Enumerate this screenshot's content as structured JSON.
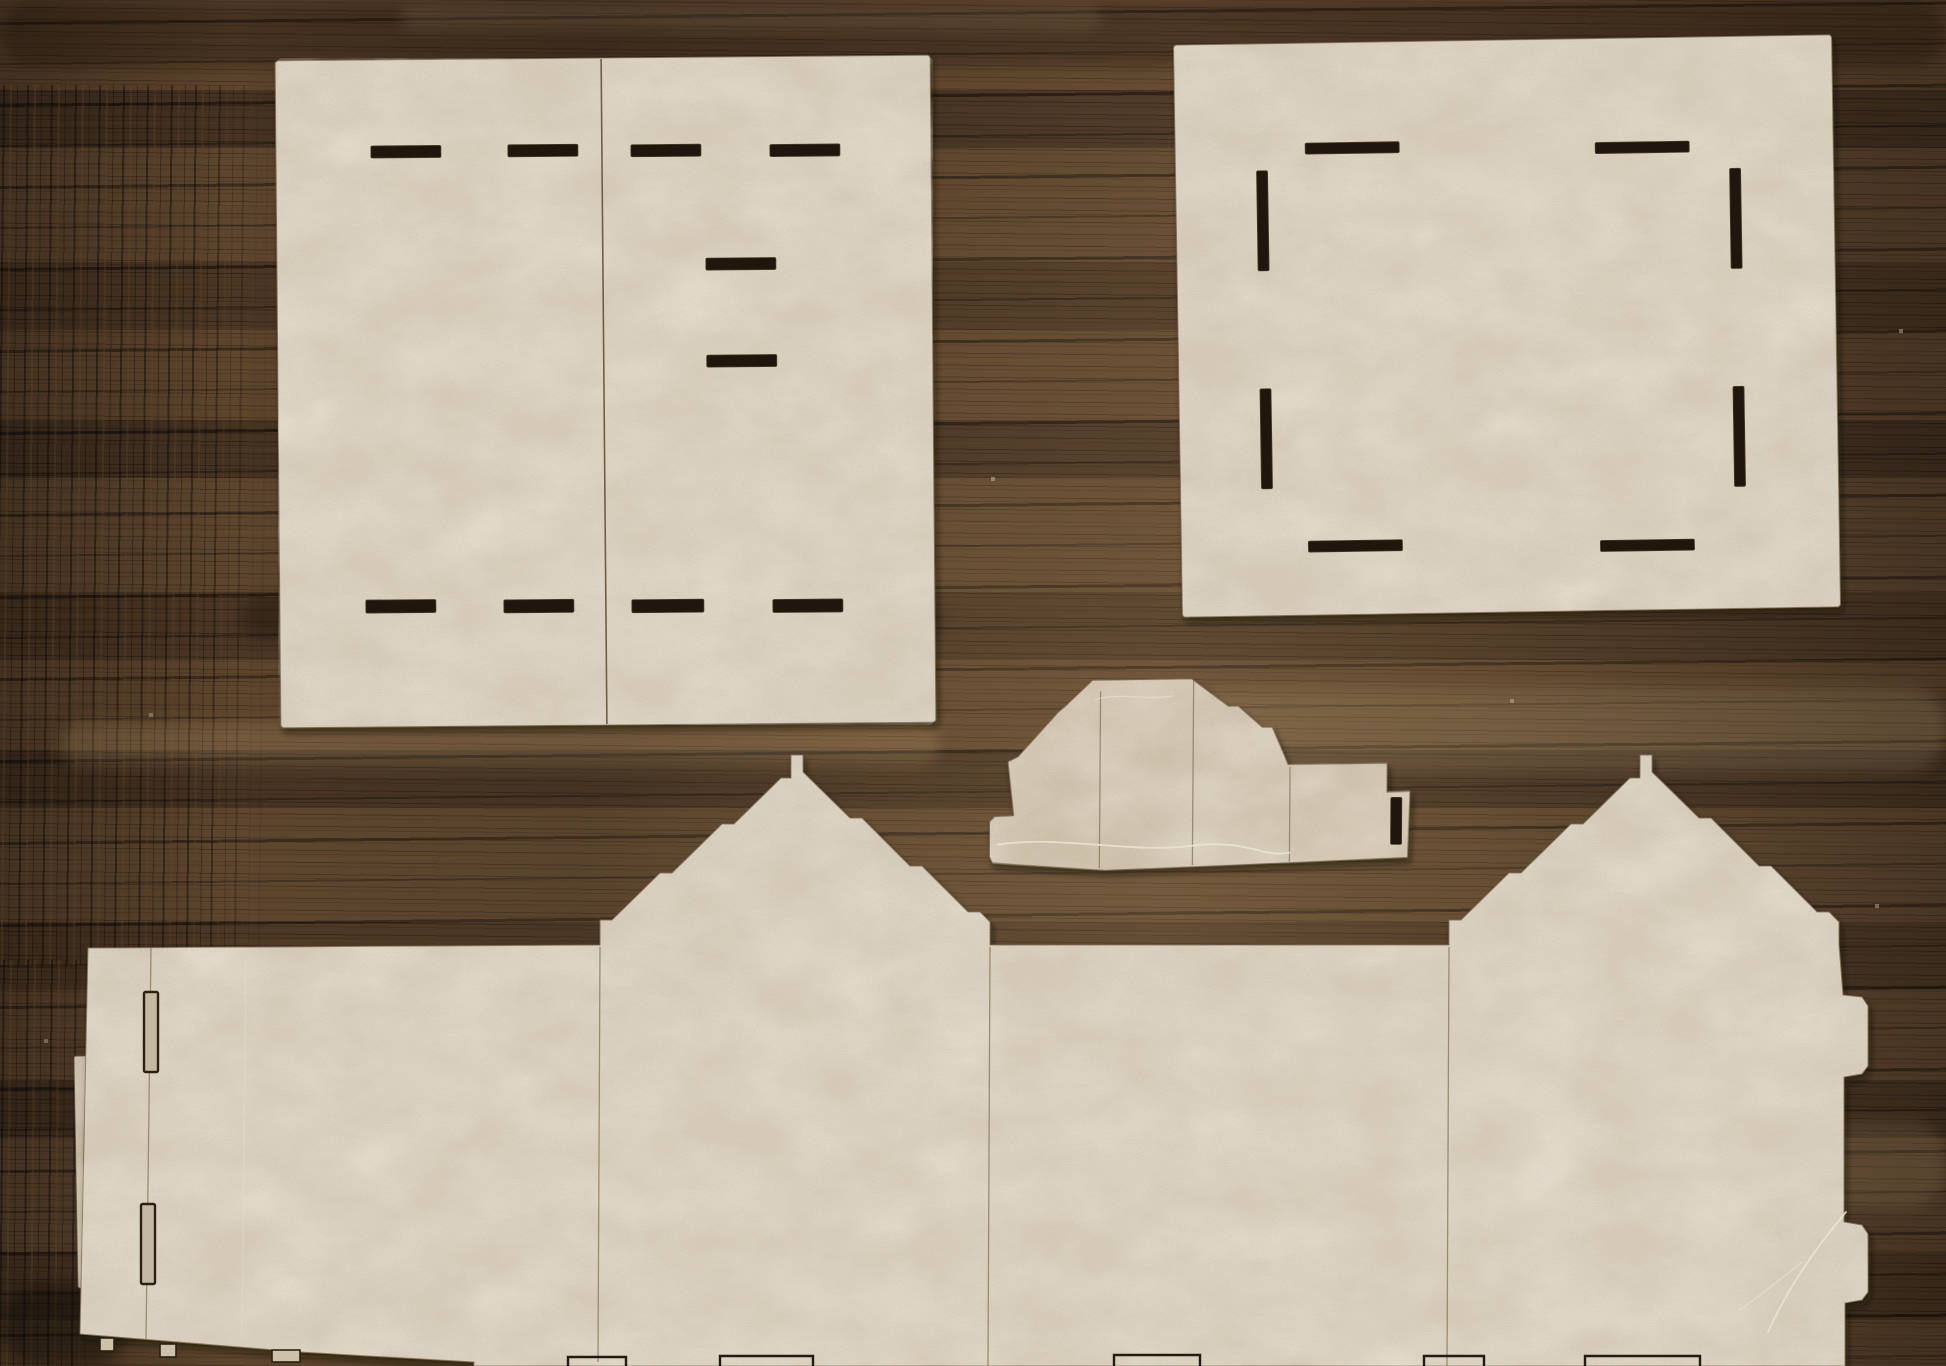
{
  "meta": {
    "description": "Photograph of five laser-cut chipboard kit pieces for a small model house, laid out on a dark oak wood table",
    "surface": "dark stained oak table with pronounced grain",
    "piece_count": 5
  },
  "colors": {
    "wood_base": "#57402a",
    "wood_dark_streak": "#1c140c",
    "wood_light_streak": "#7c5f3c",
    "cardboard": "#d7ccba",
    "cardboard_dark": "#cfc3ad",
    "cardboard_shade": "#c6b9a3",
    "slot": "#20160d",
    "slot_outline": "#2c2013",
    "edge": "#7d6c54",
    "score": "#8f7f66",
    "crack": "#ece4d4"
  },
  "pieces": {
    "roof_panel": {
      "label": "Square roof panel, two halves butted at a center fold, ten tab slots",
      "slot_count": 10,
      "slots": [
        [
          373,
          144,
          70,
          12
        ],
        [
          510,
          144,
          70,
          12
        ],
        [
          633,
          145,
          70,
          12
        ],
        [
          772,
          146,
          70,
          12
        ],
        [
          707,
          259,
          70,
          12
        ],
        [
          707,
          356,
          70,
          12
        ],
        [
          364,
          598,
          70,
          13
        ],
        [
          502,
          599,
          70,
          13
        ],
        [
          630,
          600,
          72,
          13
        ],
        [
          771,
          601,
          70,
          13
        ]
      ]
    },
    "base_panel": {
      "label": "Square base panel with eight perimeter tab slots",
      "slot_count": 8,
      "slots": [
        [
          1308,
          140,
          94,
          11
        ],
        [
          1598,
          144,
          94,
          11
        ],
        [
          1259,
          167,
          11,
          100
        ],
        [
          1732,
          172,
          11,
          100
        ],
        [
          1259,
          385,
          11,
          100
        ],
        [
          1732,
          390,
          11,
          100
        ],
        [
          1305,
          538,
          94,
          11
        ],
        [
          1597,
          542,
          94,
          11
        ]
      ]
    },
    "dormer": {
      "label": "Dormer / chimney piece with stepped slopes, side tab and one slot",
      "slot_count": 1,
      "slots": [
        [
          1391,
          796,
          11,
          47
        ]
      ]
    },
    "wall_strip": {
      "label": "Long wall strip with two stepped gable peaks, glue flap with two slots, side tabs",
      "slot_count": 2,
      "flap_slots": [
        [
          144,
          992,
          14,
          80
        ],
        [
          141,
          1204,
          14,
          80
        ]
      ]
    },
    "offcut_sliver": {
      "label": "Thin offcut sliver lying under the left flap edge"
    }
  }
}
